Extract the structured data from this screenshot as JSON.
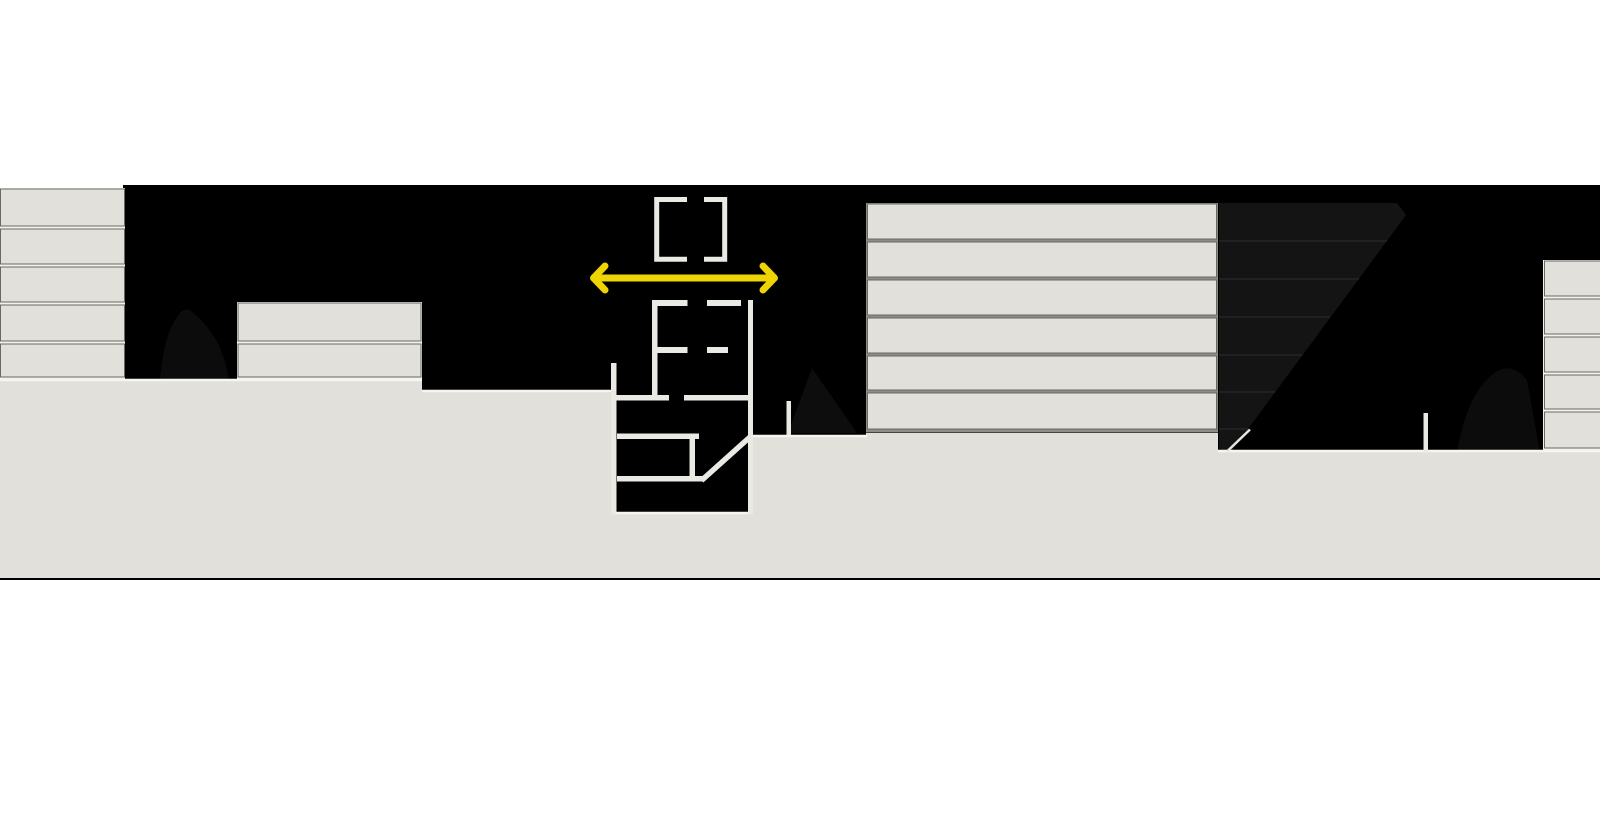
{
  "scene": {
    "type": "architectural-section-illustration",
    "description": "Black horizontal band with light-gray buildings in section, ground mass, underground station detail drawn in white lines, and a yellow horizontal double-headed dimension arrow",
    "band": {
      "top": 185,
      "bottom": 580,
      "left": 0,
      "right": 1600
    }
  },
  "colors": {
    "page_white": "#ffffff",
    "band_black": "#000000",
    "ground_gray": "#e1e0db",
    "slab_gray": "#e1e0da",
    "separator_gray": "#8d8d87",
    "light_gap": "#f3f2ed",
    "structure_white": "#eae9e4",
    "shadow_gray": "#141414",
    "tunnel_blob": "#0c0c0c",
    "accent_yellow": "#eed402",
    "building_base_line": "#44443f"
  },
  "dimension_arrow": {
    "role": "width-dimension-annotation",
    "direction": "horizontal-double-headed",
    "x_start": 593,
    "x_end": 775,
    "y": 278
  },
  "buildings": [
    {
      "id": "building-left-tower",
      "floors": 5,
      "x": 0,
      "width": 125,
      "backing": [
        0,
        188,
        125,
        192
      ],
      "backing_color": "#f3f2ed",
      "slab_x": 0.5,
      "slab_w": 124,
      "slabs": [
        [
          189,
          37
        ],
        [
          229,
          35
        ],
        [
          267,
          35
        ],
        [
          305,
          36
        ],
        [
          344,
          33
        ]
      ]
    },
    {
      "id": "building-mid-left",
      "floors": 2,
      "x": 237,
      "width": 185,
      "backing": [
        237,
        302,
        185,
        77
      ],
      "backing_color": "#f3f2ed",
      "slab_x": 238,
      "slab_w": 183,
      "slabs": [
        [
          303,
          38
        ],
        [
          344,
          33
        ]
      ]
    },
    {
      "id": "building-center-right",
      "floors": 6,
      "x": 866,
      "width": 352,
      "backing": [
        866,
        203,
        352,
        229
      ],
      "backing_color": "#8d8d87",
      "slab_x": 867.5,
      "slab_w": 349,
      "slabs": [
        [
          204,
          35
        ],
        [
          242,
          35
        ],
        [
          280,
          35
        ],
        [
          318,
          35
        ],
        [
          356,
          34
        ],
        [
          393,
          36
        ]
      ]
    },
    {
      "id": "building-far-right",
      "floors": 5,
      "x": 1543,
      "width": 57,
      "backing": [
        1543,
        260,
        57,
        190
      ],
      "backing_color": "#f3f2ed",
      "slab_x": 1544.5,
      "slab_w": 56,
      "slabs": [
        [
          261,
          35
        ],
        [
          299,
          35
        ],
        [
          337,
          35
        ],
        [
          375,
          34
        ],
        [
          412,
          36
        ]
      ]
    }
  ],
  "shadow_region": {
    "role": "shaded-building-volume-with-diagonal-edge",
    "polygon": "1219,203 1397,203 1406,215 1231,452 1219,452",
    "levels": [
      [
        241,
        1387
      ],
      [
        279,
        1359
      ],
      [
        317,
        1330
      ],
      [
        355,
        1302
      ],
      [
        392,
        1275
      ],
      [
        429,
        1248
      ]
    ]
  }
}
